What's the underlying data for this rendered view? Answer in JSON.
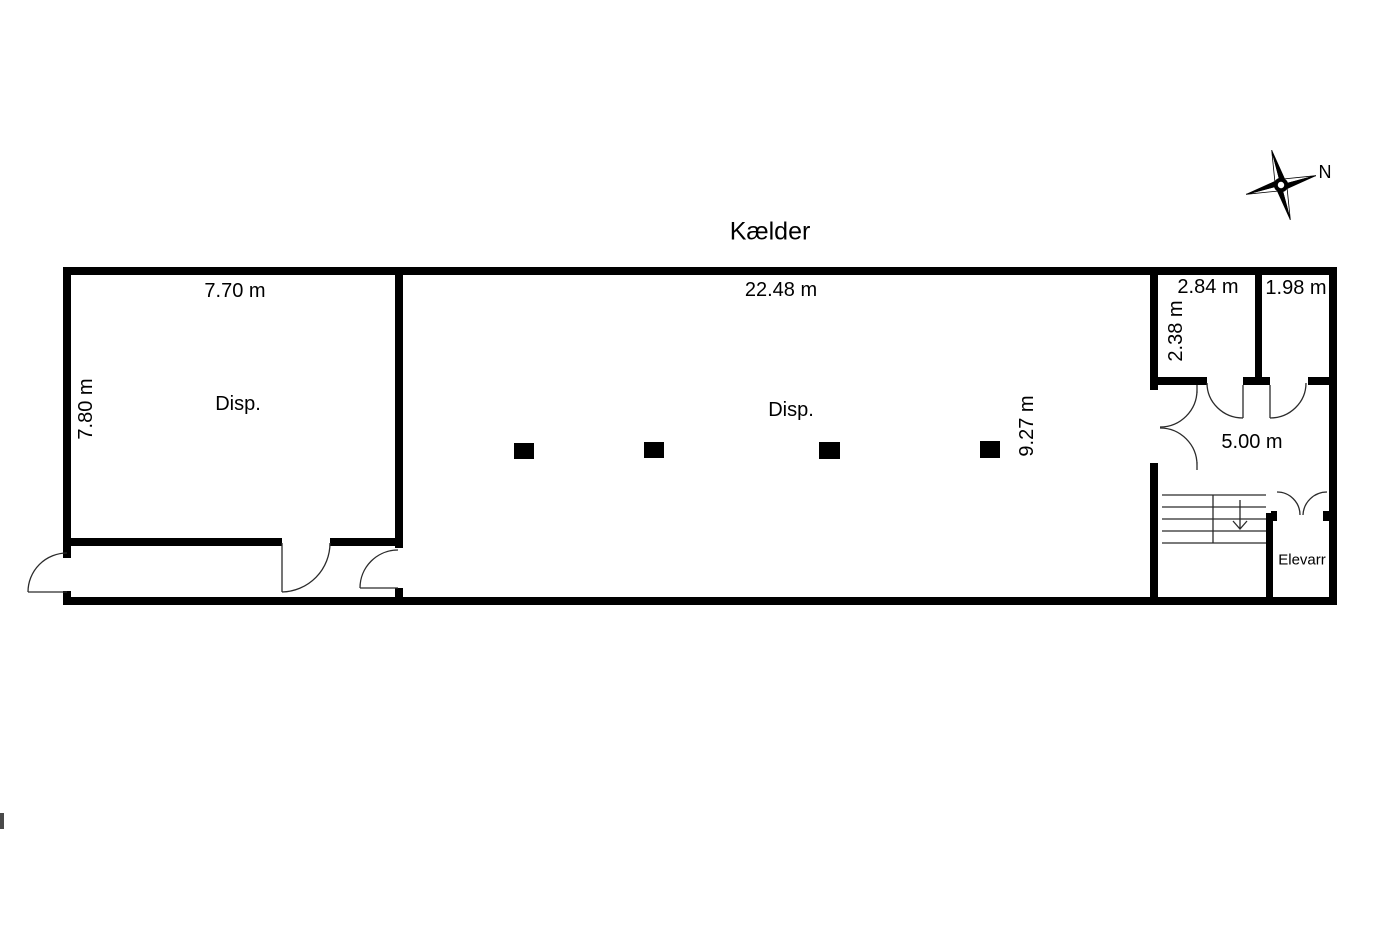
{
  "title": "Kælder",
  "compass": {
    "north_label": "N"
  },
  "rooms": {
    "left": {
      "name": "Disp.",
      "width": "7.70 m",
      "height": "7.80 m"
    },
    "central": {
      "name": "Disp.",
      "width": "22.48 m",
      "height": "9.27 m"
    },
    "top_right_inner": {
      "width": "2.84 m",
      "height": "2.38 m"
    },
    "top_right_corner": {
      "width": "1.98 m"
    },
    "stair_hall": {
      "width": "5.00 m"
    },
    "elevator": {
      "name": "Elevarr"
    }
  },
  "colors": {
    "wall": "#000000",
    "thin_line": "#2b2b2b",
    "background": "#ffffff"
  }
}
